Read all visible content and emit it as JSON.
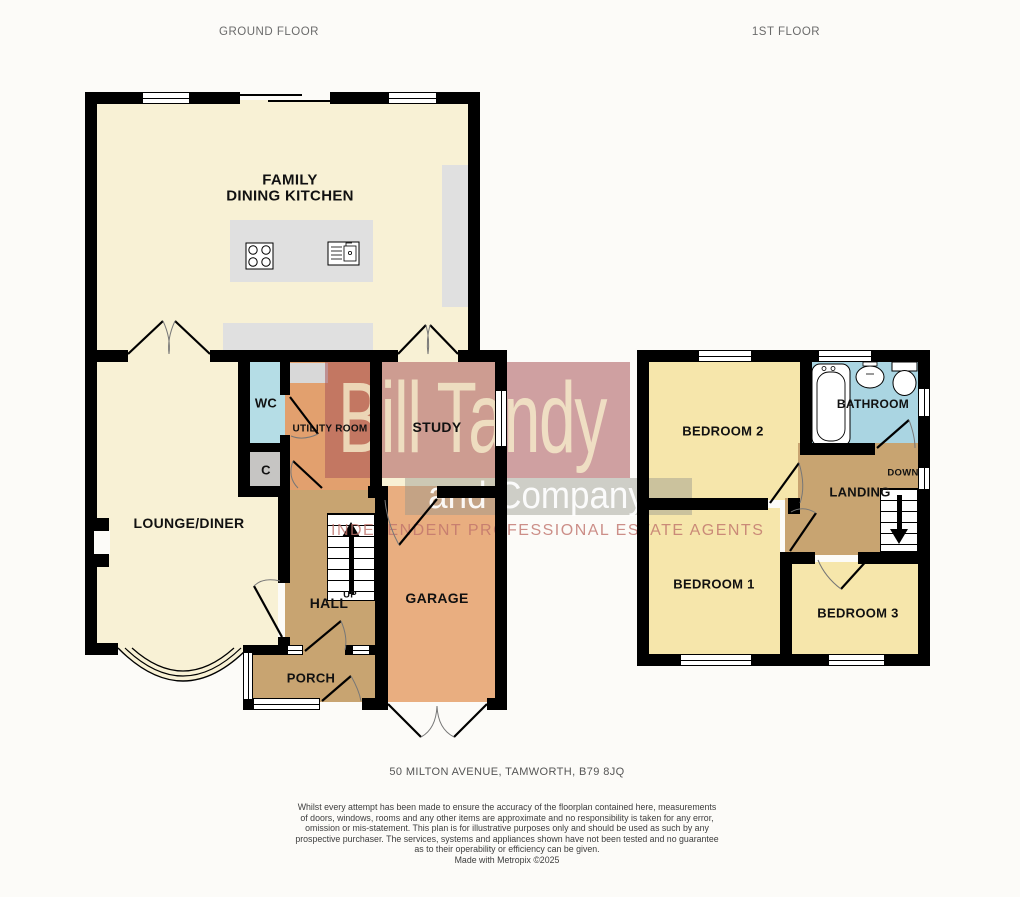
{
  "headers": {
    "ground": "GROUND FLOOR",
    "first": "1ST FLOOR"
  },
  "rooms": {
    "kitchen_line1": "FAMILY",
    "kitchen_line2": "DINING KITCHEN",
    "wc": "WC",
    "utility": "UTILITY ROOM",
    "study": "STUDY",
    "cupboard": "C",
    "lounge": "LOUNGE/DINER",
    "hall": "HALL",
    "hall_up": "UP",
    "garage": "GARAGE",
    "porch": "PORCH",
    "bedroom2": "BEDROOM 2",
    "bathroom": "BATHROOM",
    "landing": "LANDING",
    "landing_down": "DOWN",
    "bedroom1": "BEDROOM 1",
    "bedroom3": "BEDROOM 3"
  },
  "watermark": {
    "line1": "Bill Tandy",
    "line2": "and Company",
    "tagline": "INDEPENDENT PROFESSIONAL ESTATE AGENTS"
  },
  "footer": {
    "address": "50 MILTON AVENUE, TAMWORTH, B79 8JQ",
    "disclaimer": [
      "Whilst every attempt has been made to ensure the accuracy of the floorplan contained here, measurements",
      "of doors, windows, rooms and any other items are approximate and no responsibility is taken for any error,",
      "omission or mis-statement. This plan is for illustrative purposes only and should be used as such by any",
      "prospective purchaser. The services, systems and appliances shown have not been tested and no guarantee",
      "as to their operability or efficiency can be given.",
      "Made with Metropix ©2025"
    ]
  },
  "colors": {
    "cream_room": "#f8f1d5",
    "yellow_room": "#f6e6ab",
    "bathroom_blue": "#aad5e2",
    "wc_blue": "#b5dde6",
    "tan_room": "#c8a471",
    "garage_orange": "#e9ae80",
    "utility_orange": "#e2a06e",
    "cupboard_gray": "#c6c5c3",
    "counter_gray": "#e0e0e0",
    "wall": "#000000",
    "watermark_red": "rgba(170,85,90,0.55)",
    "watermark_gray": "rgba(150,150,140,0.45)",
    "watermark_text": "rgba(246,238,204,0.8)"
  }
}
